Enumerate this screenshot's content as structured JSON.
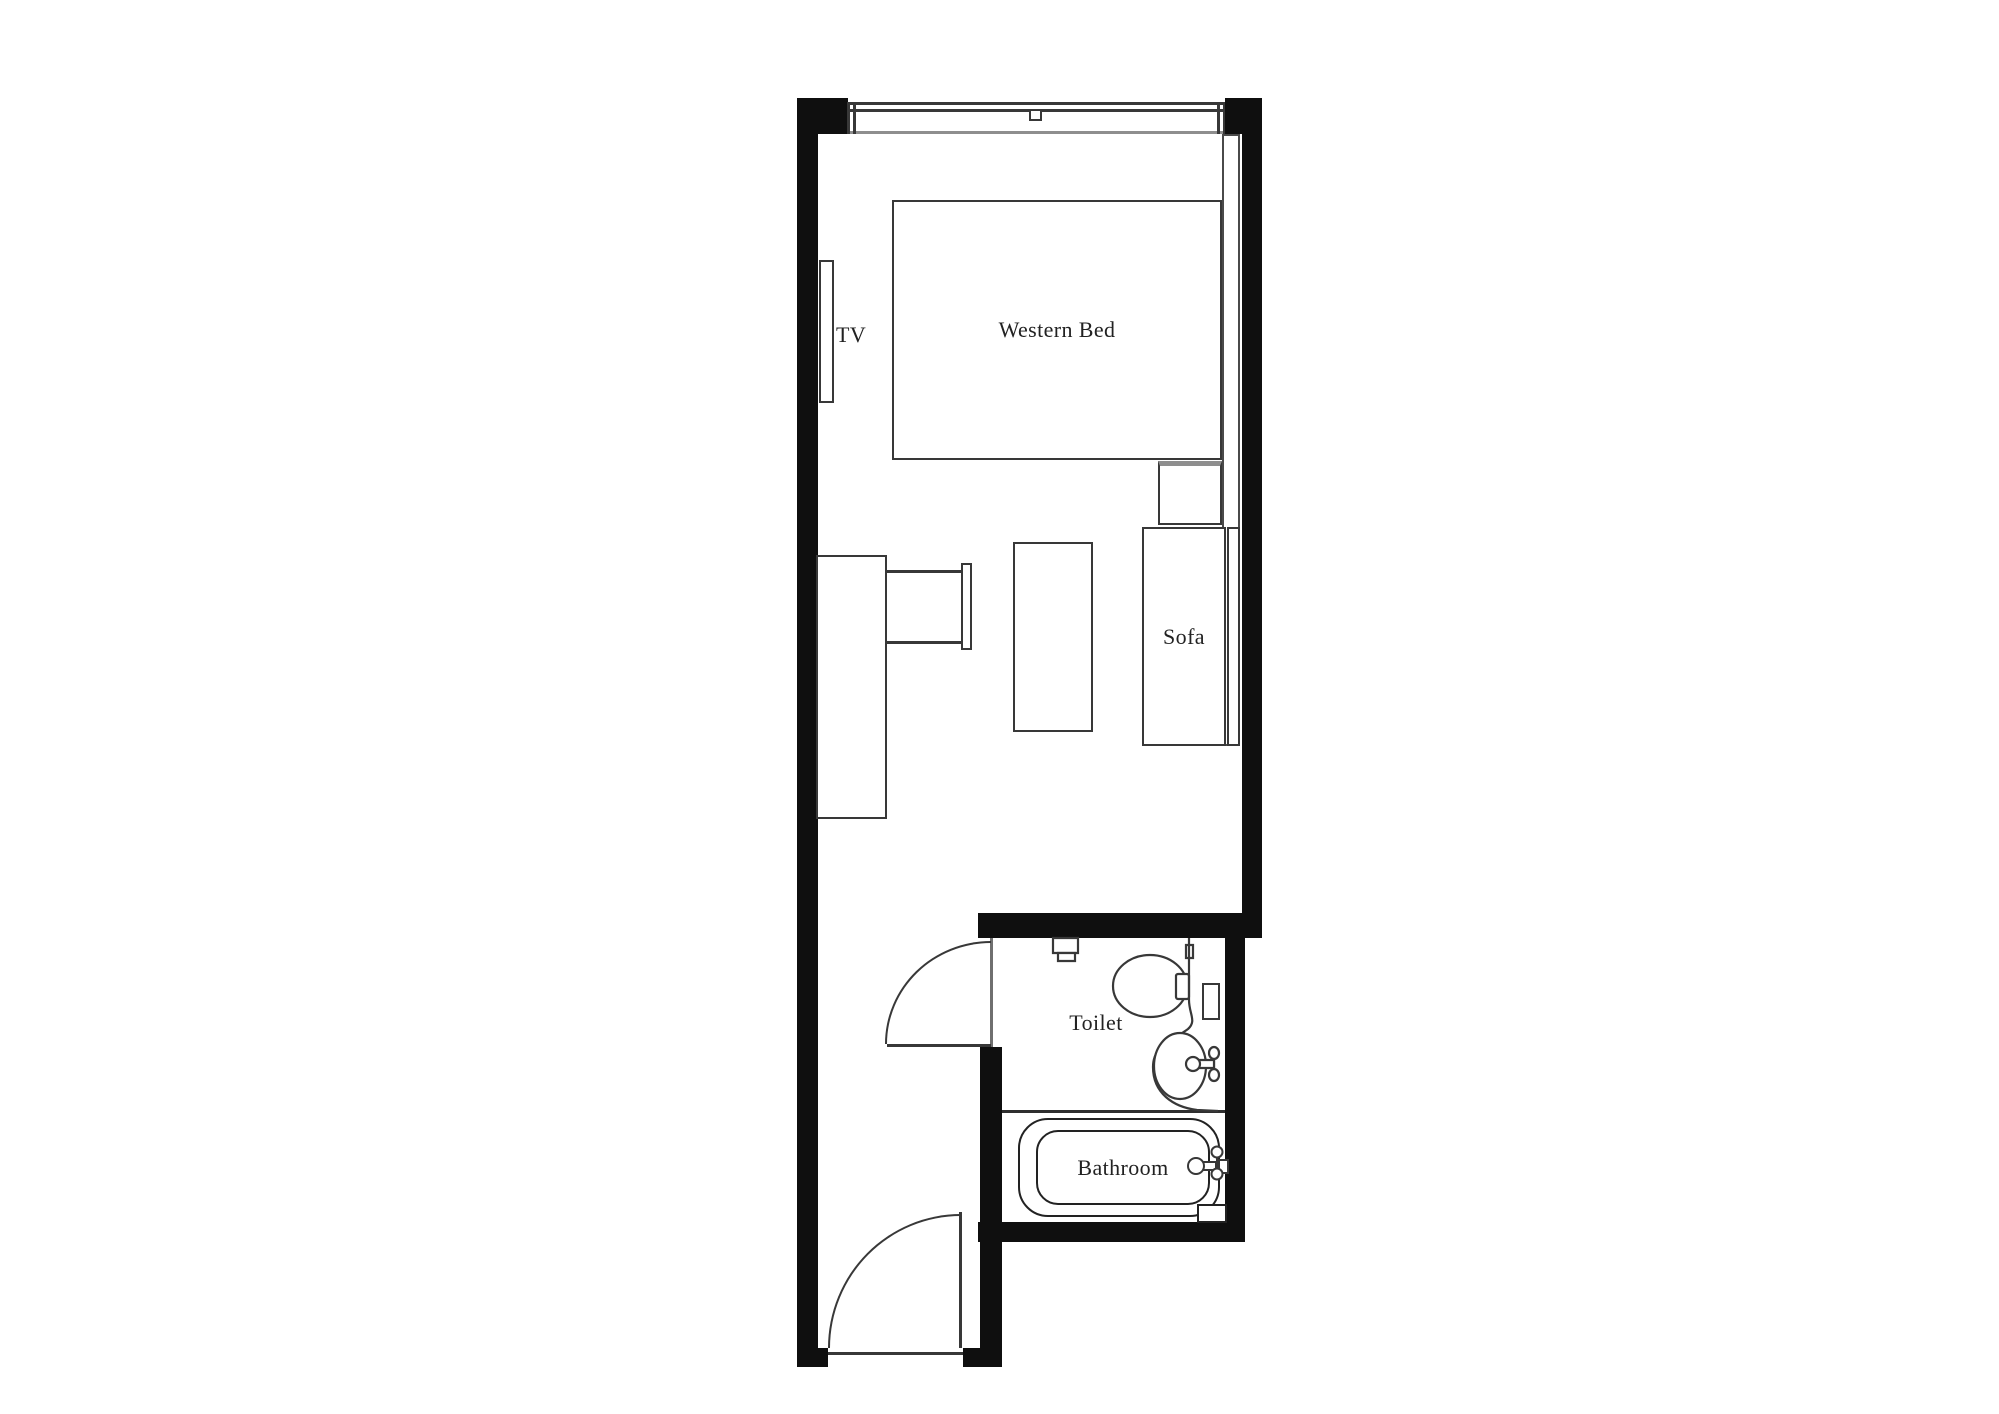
{
  "labels": {
    "tv": "TV",
    "bed": "Western Bed",
    "sofa": "Sofa",
    "toilet": "Toilet",
    "bathroom": "Bathroom"
  },
  "palette": {
    "background": "#ffffff",
    "wall": "#0f0f0f",
    "furniture_outline": "#383838",
    "soft_gray_line": "#8e8e8e",
    "text": "#222222"
  },
  "fixtures": [
    "window",
    "tv-panel",
    "western-bed",
    "nightstand",
    "desk",
    "desk-chair",
    "coffee-table",
    "sofa",
    "bathroom-door",
    "toilet-cistern",
    "toilet-bowl",
    "vanity-counter",
    "wash-basin",
    "wall-shelf",
    "bathtub",
    "tub-faucet",
    "entrance-door"
  ]
}
